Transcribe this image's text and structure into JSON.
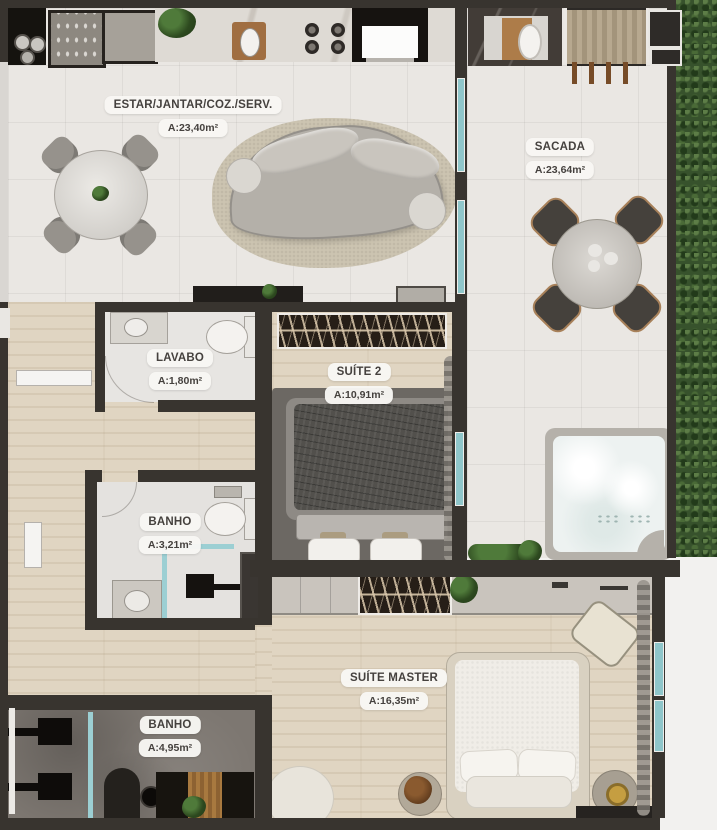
{
  "rooms": [
    {
      "name": "ESTAR/JANTAR/COZ./SERV.",
      "area": "A:23,40m²"
    },
    {
      "name": "SACADA",
      "area": "A:23,64m²"
    },
    {
      "name": "LAVABO",
      "area": "A:1,80m²"
    },
    {
      "name": "SUÍTE 2",
      "area": "A:10,91m²"
    },
    {
      "name": "BANHO",
      "area": "A:3,21m²"
    },
    {
      "name": "SUÍTE MASTER",
      "area": "A:16,35m²"
    },
    {
      "name": "BANHO",
      "area": "A:4,95m²"
    }
  ],
  "colors": {
    "wall": "#38342f",
    "floor_tile": "#eae7e3",
    "floor_wood": "#e0d5c2",
    "floor_concrete": "#7d7771",
    "glass": "#8fc6ca",
    "hedge": "#37522c",
    "rug": "#ccc4b1",
    "sofa": "#b4b0a9",
    "label_bg": "#f8f7f4",
    "label_text": "#45413e"
  },
  "furniture_icons": [
    "dining-table-icon",
    "dining-chair-icon",
    "sofa-icon",
    "area-rug-icon",
    "kitchen-sink-icon",
    "cooktop-icon",
    "oven-icon",
    "refrigerator-icon",
    "dishwasher-icon",
    "balcony-table-icon",
    "balcony-chair-icon",
    "deck-bench-icon",
    "outdoor-tub-icon",
    "jacuzzi-icon",
    "toilet-icon",
    "washbasin-icon",
    "shower-icon",
    "double-bed-icon",
    "wardrobe-icon",
    "closet-icon",
    "armchair-icon",
    "side-table-icon",
    "bench-icon",
    "planter-icon",
    "curtain-icon"
  ]
}
